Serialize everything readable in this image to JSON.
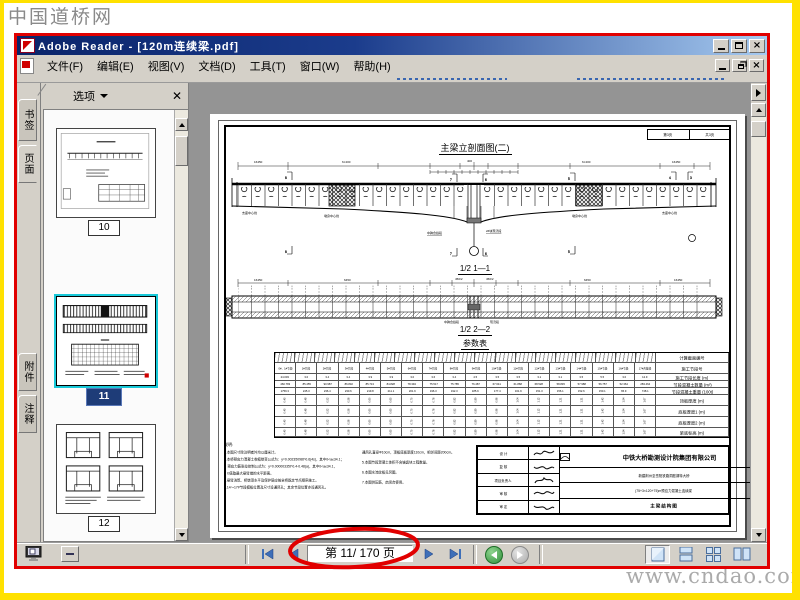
{
  "watermarks": {
    "top_left": "中国道桥网",
    "bottom_right": "www.cndao.com"
  },
  "colors": {
    "accent_red": "#E10000",
    "frame_yellow": "#FFE100",
    "titlebar_blue": "#0A246A",
    "selection_cyan": "#17C8D8"
  },
  "window": {
    "title": "Adobe Reader - [120m连续梁.pdf]",
    "menus": [
      "文件(F)",
      "编辑(E)",
      "视图(V)",
      "文档(D)",
      "工具(T)",
      "窗口(W)",
      "帮助(H)"
    ]
  },
  "sidebar": {
    "tabs": [
      "书签",
      "页面",
      "附件",
      "注释"
    ],
    "panel": {
      "options_label": "选项"
    },
    "thumbnails": [
      {
        "page": "10",
        "selected": false
      },
      {
        "page": "11",
        "selected": true
      },
      {
        "page": "12",
        "selected": false
      }
    ]
  },
  "document": {
    "corner_box": {
      "left": "第3页",
      "right": "共3页"
    },
    "view1_title": "主梁立剖面图(二)",
    "view1_dims": [
      "16450",
      "6×400",
      "400",
      "6×400",
      "16450"
    ],
    "view1_labels": [
      "支座中心线",
      "墩身中心线",
      "中跨合拢段",
      "2#块现浇段",
      "墩身中心线",
      "支座中心线"
    ],
    "cut_marks": [
      "8",
      "7",
      "6",
      "5",
      "4",
      "3"
    ],
    "section1_title": "1/2 1—1",
    "view2_dims": [
      "16450",
      "6450",
      "450/2",
      "450/2",
      "6450",
      "16450"
    ],
    "view2_labels": [
      "中跨合拢段",
      "现浇段"
    ],
    "section2_title": "1/2 2—2",
    "table_title": "参数表",
    "param_table": {
      "row_labels": [
        "计算截面编号",
        "施工节段号",
        "施工节段长度 (m)",
        "节段混凝土数量 (m³)",
        "节段混凝土重量 (100t)",
        "顶板厚度 (m)",
        "底板厚度1 (m)",
        "底板厚度2 (m)",
        "梁底标高 (m)"
      ],
      "segments": [
        "0#、1#节段",
        "1#节段",
        "2#节段",
        "3#节段",
        "4#节段",
        "5#节段",
        "6#节段",
        "7#节段",
        "8#节段",
        "9#节段",
        "10#节段",
        "11#节段",
        "12#节段",
        "13#节段",
        "14#节段",
        "15#节段",
        "16#节段",
        "17#合拢段",
        "18#边跨现浇段"
      ],
      "seg_len": [
        "24.003",
        "3.0",
        "3.4",
        "3.4",
        "3.9",
        "3.9",
        "3.0",
        "3.6",
        "3.4",
        "4.5",
        "3.5",
        "3.5",
        "3.1",
        "3.1",
        "3.5",
        "5.5",
        "3.0",
        "12.9"
      ],
      "concrete_vol": [
        "460.783",
        "85.455",
        "90.987",
        "86.832",
        "85.713",
        "84.828",
        "78.394",
        "75.517",
        "75.785",
        "76.487",
        "67.641",
        "61.868",
        "68.528",
        "58.845",
        "57.988",
        "56.757",
        "52.364",
        "283.464"
      ],
      "concrete_wt": [
        "1759.3",
        "245.3",
        "236.4",
        "230.6",
        "219.8",
        "211.1",
        "201.9",
        "196.3",
        "192.3",
        "185.9",
        "177.4",
        "161.9",
        "151.3",
        "156.1",
        "152.6",
        "150.1",
        "65.9",
        "748.1"
      ],
      "thickness": [
        "0.45",
        "0.48",
        "0.52",
        "0.56",
        "0.60",
        "0.65",
        "0.70",
        "0.76",
        "0.82",
        "0.89",
        "0.96",
        "1.04",
        "1.12",
        "1.21",
        "1.31",
        "1.42",
        "1.54",
        "1.67"
      ]
    },
    "notes": {
      "heading": "说明:",
      "left": [
        "1.本图尺寸除注明者外均以厘米计。",
        "2.本桥预应力混凝土收缩徐变公式为：y=0.00235098t^0.6(4s)，其中0<a≤34.1；",
        "　预应力筋张拉控制公式为：y=0.00000335t^0.4-0.48(a)，其中0<a≤34.1，",
        "　b值取最大悬臂端的水平距离。",
        "3.悬臂浇筑、桥墩顶水平及保护层应按全桥既定节点顺序施工。",
        "4.14～17#节段模板位置及尺寸设通风孔；其余节段位置亦设通风孔。"
      ],
      "right": [
        "通风孔直径Φ10cm，顶板底板厚度110cm，相邻间距200cm。",
        "5.本图节段混凝土体积不含锚齿块工程数量。",
        "6.本图水流纹板见另图。",
        "7.本图供压筋，启闭合使用。"
      ]
    },
    "title_block": {
      "sign_labels": [
        "设 计",
        "复 核",
        "项目负责人",
        "审 核",
        "审 定"
      ],
      "company": "中铁大桥勘测设计院集团有限公司",
      "project": "新建荆州至岳阳铁路洞庭湖特大桥",
      "span_config": "(75+3×120+75)m预应力混凝土连续梁",
      "drawing_name": "主梁结构图",
      "drawing_type": "施 工 图",
      "info_rows": [
        [
          "图 号",
          "DK110-04-1313"
        ],
        [
          "版本号",
          "A"
        ],
        [
          "比 例",
          "1:400"
        ],
        [
          "日 期",
          "2013.03"
        ]
      ]
    }
  },
  "statusbar": {
    "page_field": "第 11/ 170 页",
    "layout_buttons": [
      "single-page",
      "continuous",
      "continuous-facing",
      "facing"
    ]
  }
}
